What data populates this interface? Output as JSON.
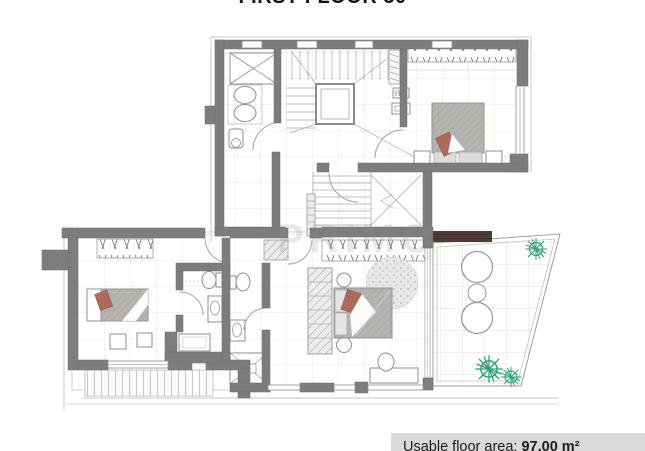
{
  "title": "FIRST FLOOR 30",
  "watermark": "PRIMO",
  "area_panel": {
    "label": "Usable floor area:",
    "value": "97,00 m²"
  },
  "colors": {
    "wall_gray": "#7d7d7d",
    "accent_red": "#ad6a5a",
    "plant_green": "#2f9e77",
    "terrace_wood": "#4e3b33",
    "panel_bg": "#d9d9d9",
    "bed_gray": "#b5b3b2",
    "grid_beige": "#ebe6d8",
    "line_gray": "#9a9a9a"
  }
}
